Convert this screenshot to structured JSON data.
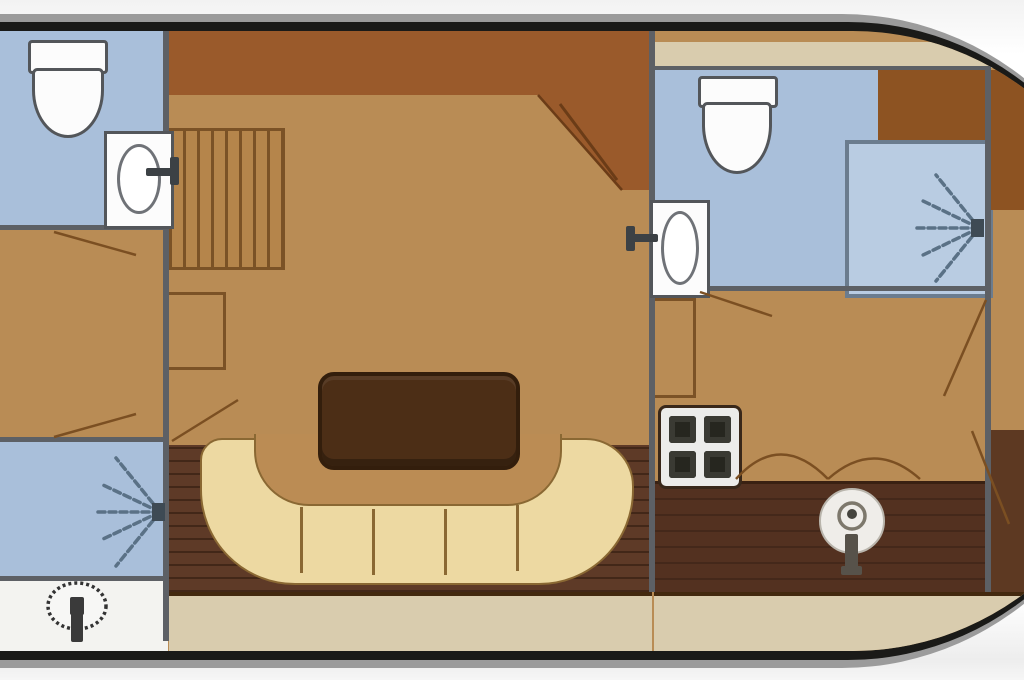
{
  "diagram": {
    "type": "boat-deck-floor-plan",
    "orientation": "bow-right-stern-cut-left",
    "visible_text": [],
    "palette": {
      "hull_outline": "#1a1a18",
      "gunwale_gray": "#9b9b9b",
      "floor_tan": "#b98c55",
      "sideboard_sienna": "#9a5a2b",
      "wardrobe_brown": "#8d5322",
      "plank_deck_dark": "#5e3a27",
      "galley_counter_dark": "#533120",
      "settee_cream": "#edd9a2",
      "side_deck_beige": "#d9ccae",
      "wet_room_blue": "#a9bfda",
      "shower_stall_blue": "#b9cce2",
      "wall_gray": "#5d6065",
      "fixture_white": "#fcfcfc",
      "table_wood": "#4c2e16",
      "outline_brown": "#7b5226",
      "spray_slate": "#5a7186"
    },
    "sections": [
      {
        "name": "aft-section-left",
        "rooms": [
          {
            "name": "aft-bathroom",
            "color": "wet_room_blue",
            "fixtures": [
              "toilet",
              "washbasin-with-faucet"
            ]
          },
          {
            "name": "aft-cabin",
            "color": "floor_tan",
            "fixtures": [
              "door-swing-top",
              "door-swing-bottom"
            ]
          },
          {
            "name": "aft-shower-room",
            "color": "wet_room_blue",
            "fixtures": [
              "shower-spray"
            ]
          },
          {
            "name": "aft-steering-area",
            "color": "fixture_white",
            "fixtures": [
              "steering-wheel"
            ]
          }
        ]
      },
      {
        "name": "midship-section",
        "rooms": [
          {
            "name": "saloon",
            "color": "floor_tan",
            "fixtures": [
              "companionway-stairs",
              "side-cabinet",
              "dinette-table",
              "sideboard-band",
              "door-swing-to-forward"
            ]
          },
          {
            "name": "aft-plank-deck",
            "color": "plank_deck_dark",
            "fixtures": [
              "u-shaped-settee",
              "door-swing"
            ]
          },
          {
            "name": "side-deck",
            "color": "side_deck_beige",
            "fixtures": []
          }
        ]
      },
      {
        "name": "forward-section-right",
        "rooms": [
          {
            "name": "forward-bathroom",
            "color": "wet_room_blue",
            "fixtures": [
              "toilet",
              "washbasin-with-faucet",
              "shower-stall-with-spray"
            ]
          },
          {
            "name": "forward-cabin",
            "color": "floor_tan",
            "fixtures": [
              "wardrobe",
              "tall-cabinet",
              "door-swing",
              "seat-scallops"
            ]
          },
          {
            "name": "galley",
            "color": "galley_counter_dark",
            "fixtures": [
              "four-burner-stove",
              "round-basin-with-faucet"
            ]
          },
          {
            "name": "bow-cabin-sliver",
            "color": "floor_tan",
            "fixtures": [
              "wardrobe",
              "door-swing",
              "door-swing"
            ]
          }
        ]
      }
    ]
  }
}
